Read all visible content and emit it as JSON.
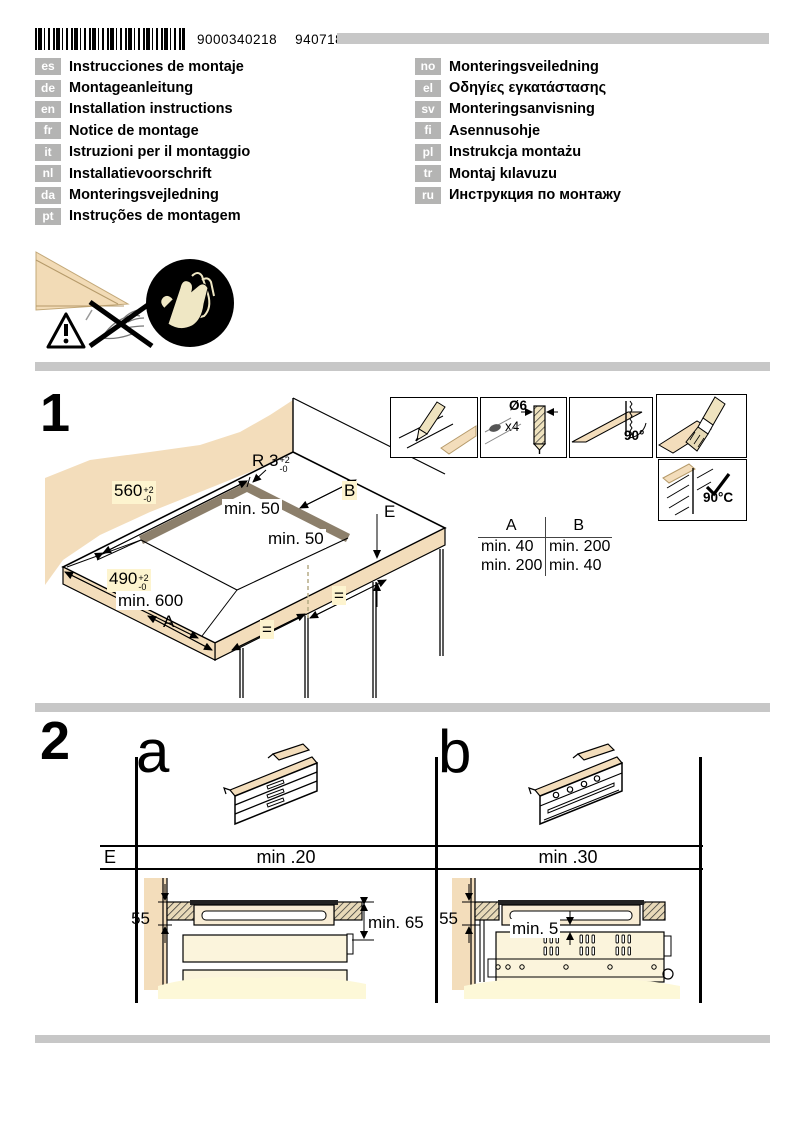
{
  "header": {
    "barcode_number": "9000340218",
    "print_code": "940718"
  },
  "languages": {
    "left": [
      {
        "code": "es",
        "label": "Instrucciones de montaje"
      },
      {
        "code": "de",
        "label": "Montageanleitung"
      },
      {
        "code": "en",
        "label": "Installation instructions"
      },
      {
        "code": "fr",
        "label": "Notice de montage"
      },
      {
        "code": "it",
        "label": "Istruzioni per il montaggio"
      },
      {
        "code": "nl",
        "label": "Installatievoorschrift"
      },
      {
        "code": "da",
        "label": "Monteringsvejledning"
      },
      {
        "code": "pt",
        "label": "Instruções de montagem"
      }
    ],
    "right": [
      {
        "code": "no",
        "label": "Monteringsveiledning"
      },
      {
        "code": "el",
        "label": "Οδηγίες εγκατάστασης"
      },
      {
        "code": "sv",
        "label": "Monteringsanvisning"
      },
      {
        "code": "fi",
        "label": "Asennusohje"
      },
      {
        "code": "pl",
        "label": "Instrukcja montażu"
      },
      {
        "code": "tr",
        "label": "Montaj kılavuzu"
      },
      {
        "code": "ru",
        "label": "Инструкция по монтажу"
      }
    ]
  },
  "section1": {
    "number": "1",
    "labels": {
      "width_value": "560",
      "width_tol_plus": "+2",
      "width_tol_minus": "-0",
      "depth_value": "490",
      "depth_tol_plus": "+2",
      "depth_tol_minus": "-0",
      "radius_value": "R 3",
      "radius_tol_plus": "+2",
      "radius_tol_minus": "-0",
      "rear_gap": "min. 50",
      "side_gap": "min. 50",
      "height": "min. 600",
      "a": "A",
      "b": "B",
      "e": "E",
      "equal1": "=",
      "equal2": "="
    },
    "steps": {
      "drill_diameter": "Ø6",
      "drill_count": "x4",
      "saw_angle": "90°",
      "glue_temp": "90°C"
    },
    "clearance_table": {
      "header_a": "A",
      "header_b": "B",
      "rows": [
        {
          "a": "min. 40",
          "b": "min. 200"
        },
        {
          "a": "min. 200",
          "b": "min. 40"
        }
      ]
    }
  },
  "section2": {
    "number": "2",
    "variant_a_label": "a",
    "variant_b_label": "b",
    "row_label": "E",
    "a_min": "min .20",
    "b_min": "min .30",
    "a_depth": "55",
    "a_clearance": "min. 65",
    "b_depth": "55",
    "b_clearance": "min. 5"
  }
}
